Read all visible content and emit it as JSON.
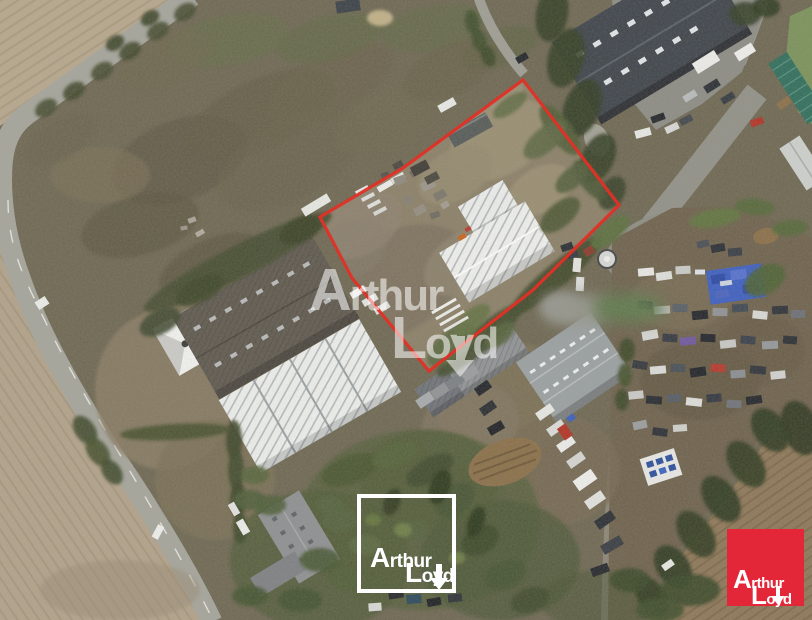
{
  "watermark": {
    "line1_cap": "A",
    "line1_rest": "rthur",
    "line2_cap": "L",
    "line2_rest": "oyd"
  },
  "outlined_logo": {
    "line1_cap": "A",
    "line1_rest": "rthur",
    "line2_cap": "L",
    "line2_rest": "oyd"
  },
  "brand_logo": {
    "line1_cap": "A",
    "line1_rest": "rthur",
    "line2_cap": "L",
    "line2_rest": "oyd"
  },
  "colors": {
    "parcel_outline": "#e03026",
    "brand_red": "#e32739",
    "logo_border": "#ffffff",
    "watermark_text": "#ffffff"
  }
}
